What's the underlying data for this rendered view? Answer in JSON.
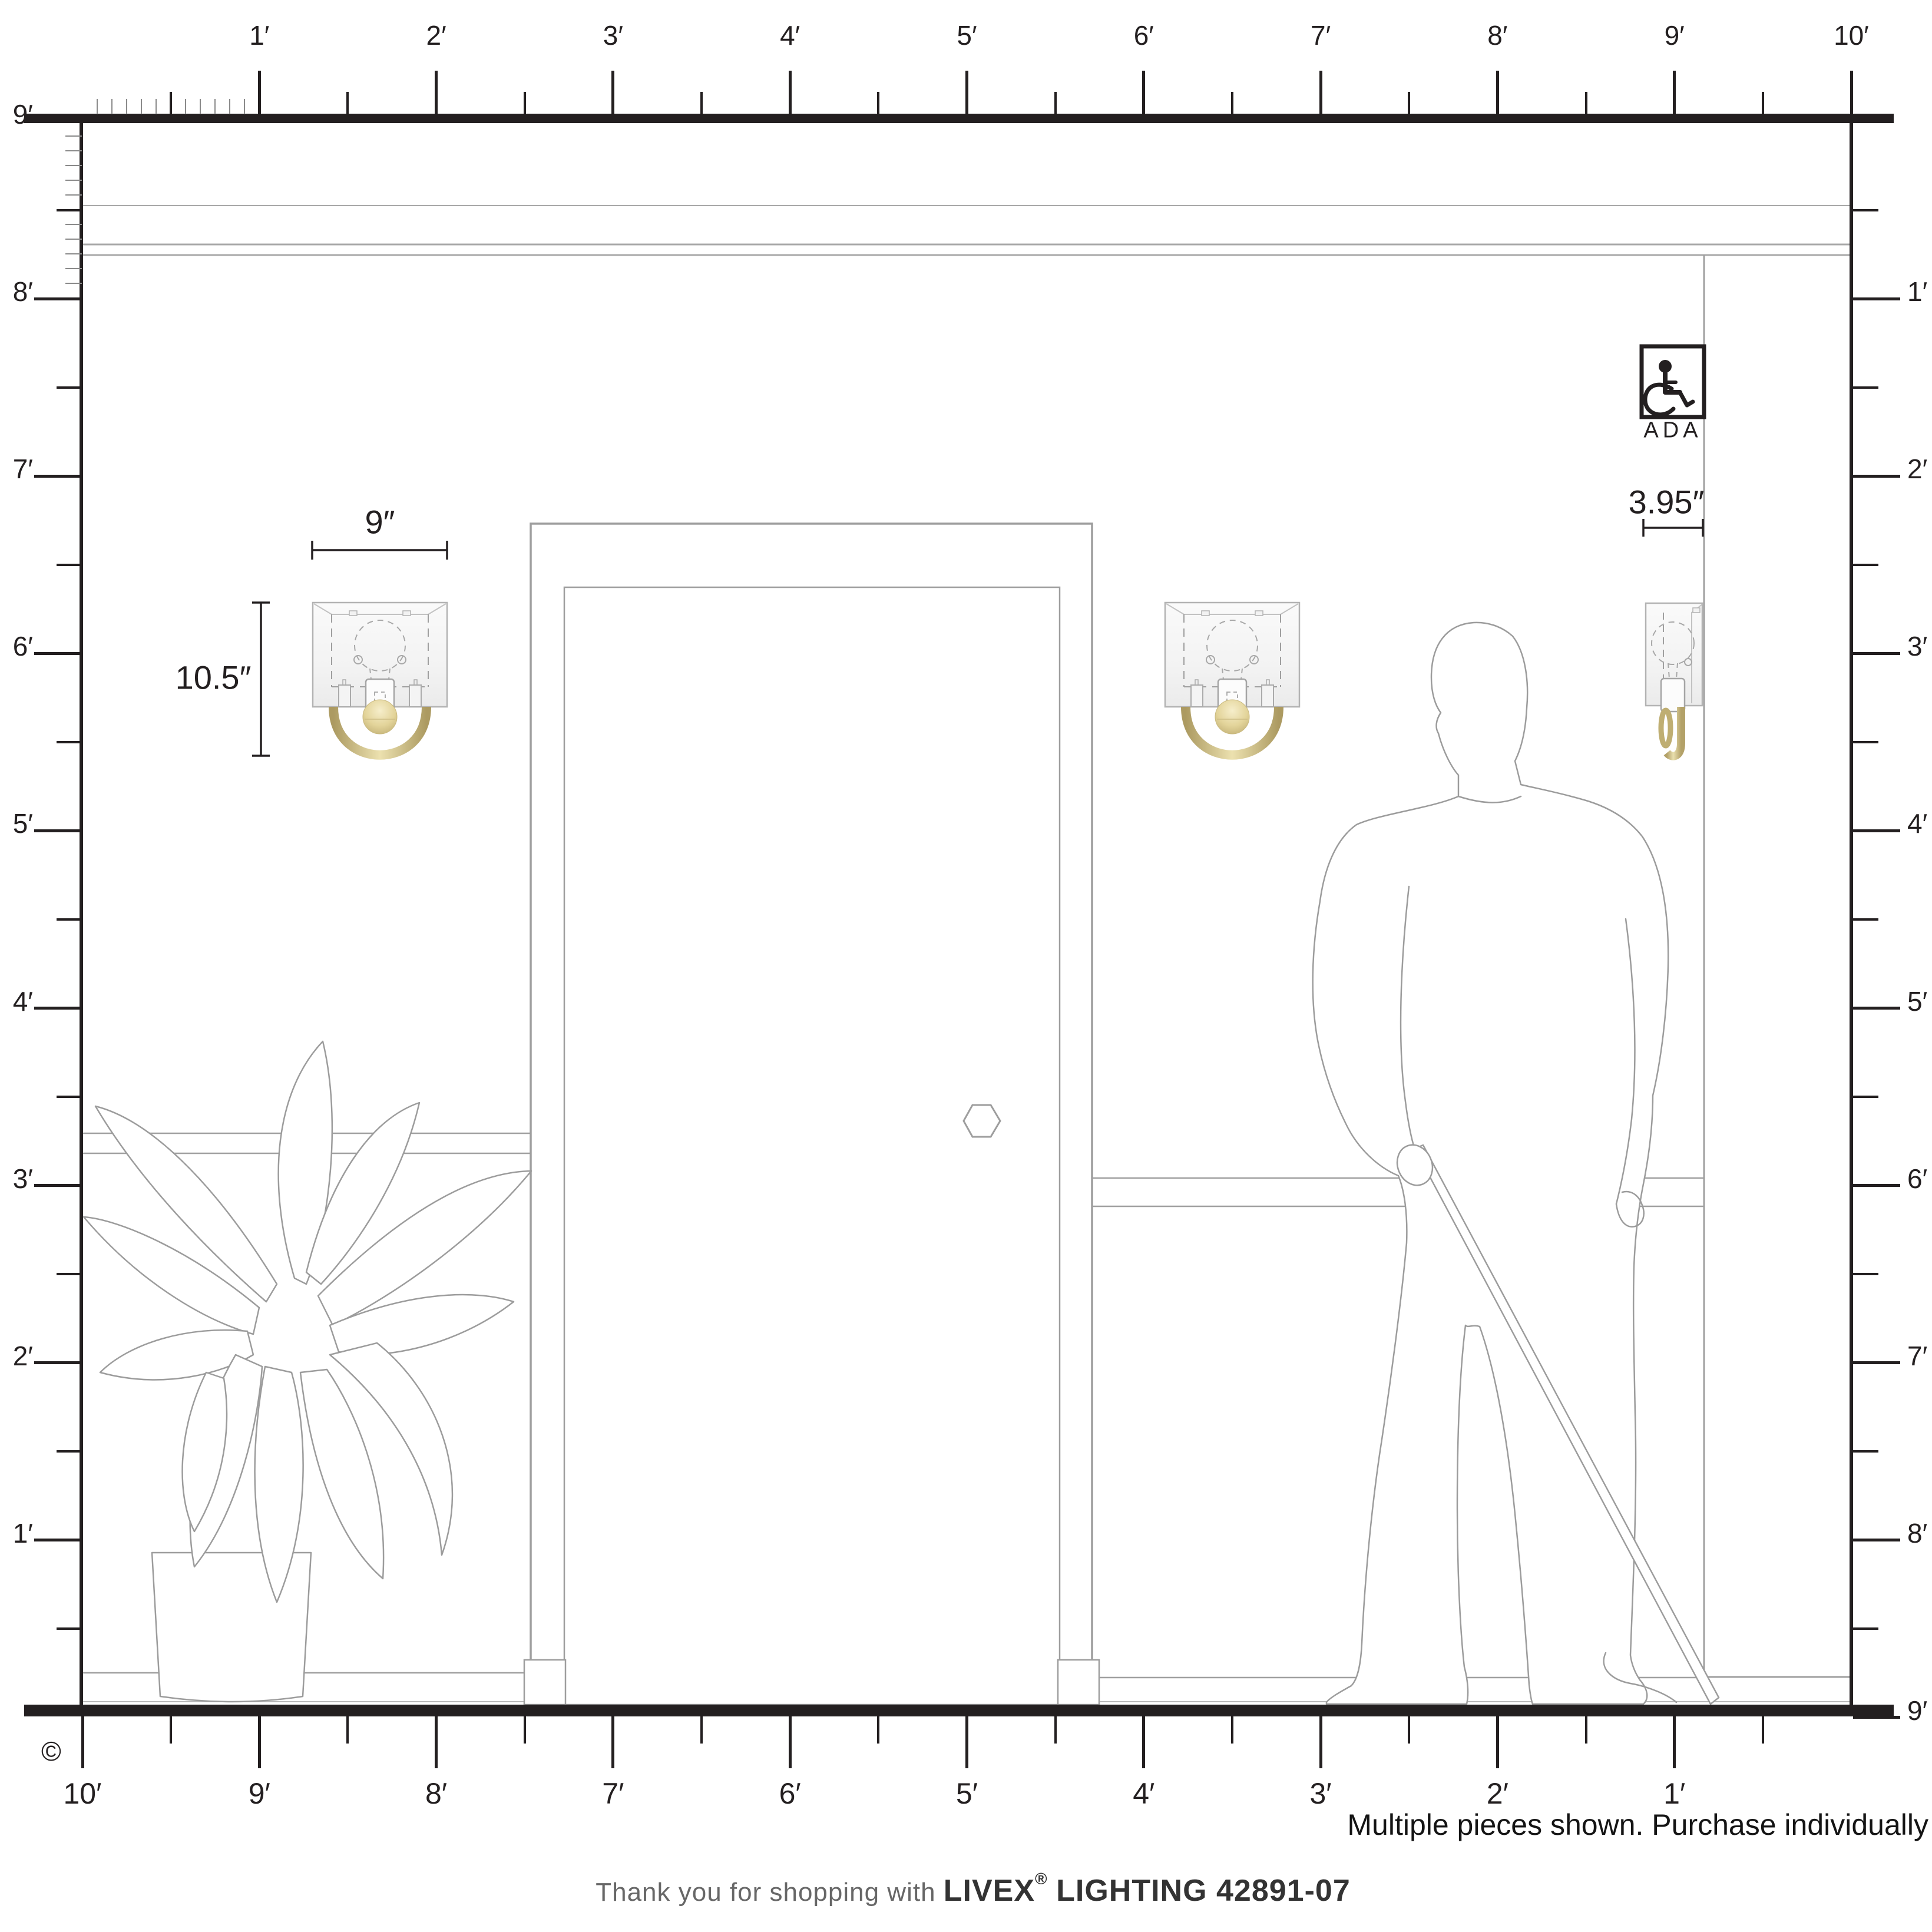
{
  "note": "Multiple pieces shown. Purchase individually",
  "footer": {
    "prefix": "Thank you for shopping with ",
    "brand": "LIVEX",
    "registered": "®",
    "suffix": " LIGHTING 42891-07"
  },
  "copyright": "©",
  "ada_label": "ADA",
  "dimensions": {
    "width": "9″",
    "height": "10.5″",
    "depth": "3.95″"
  },
  "rulers": {
    "top": {
      "labels": [
        "1′",
        "2′",
        "3′",
        "4′",
        "5′",
        "6′",
        "7′",
        "8′",
        "9′",
        "10′"
      ]
    },
    "left": {
      "labels": [
        "9′",
        "8′",
        "7′",
        "6′",
        "5′",
        "4′",
        "3′",
        "2′",
        "1′"
      ]
    },
    "right": {
      "labels": [
        "1′",
        "2′",
        "3′",
        "4′",
        "5′",
        "6′",
        "7′",
        "8′",
        "9′"
      ]
    },
    "bottom": {
      "labels": [
        "10′",
        "9′",
        "8′",
        "7′",
        "6′",
        "5′",
        "4′",
        "3′",
        "2′",
        "1′"
      ]
    }
  },
  "colors": {
    "ink": "#231f20",
    "outline_gray": "#9c9c9c",
    "gold": "#c9b77d",
    "gold_light": "#eee3b6",
    "shade_fill": "#f5f5f5"
  }
}
